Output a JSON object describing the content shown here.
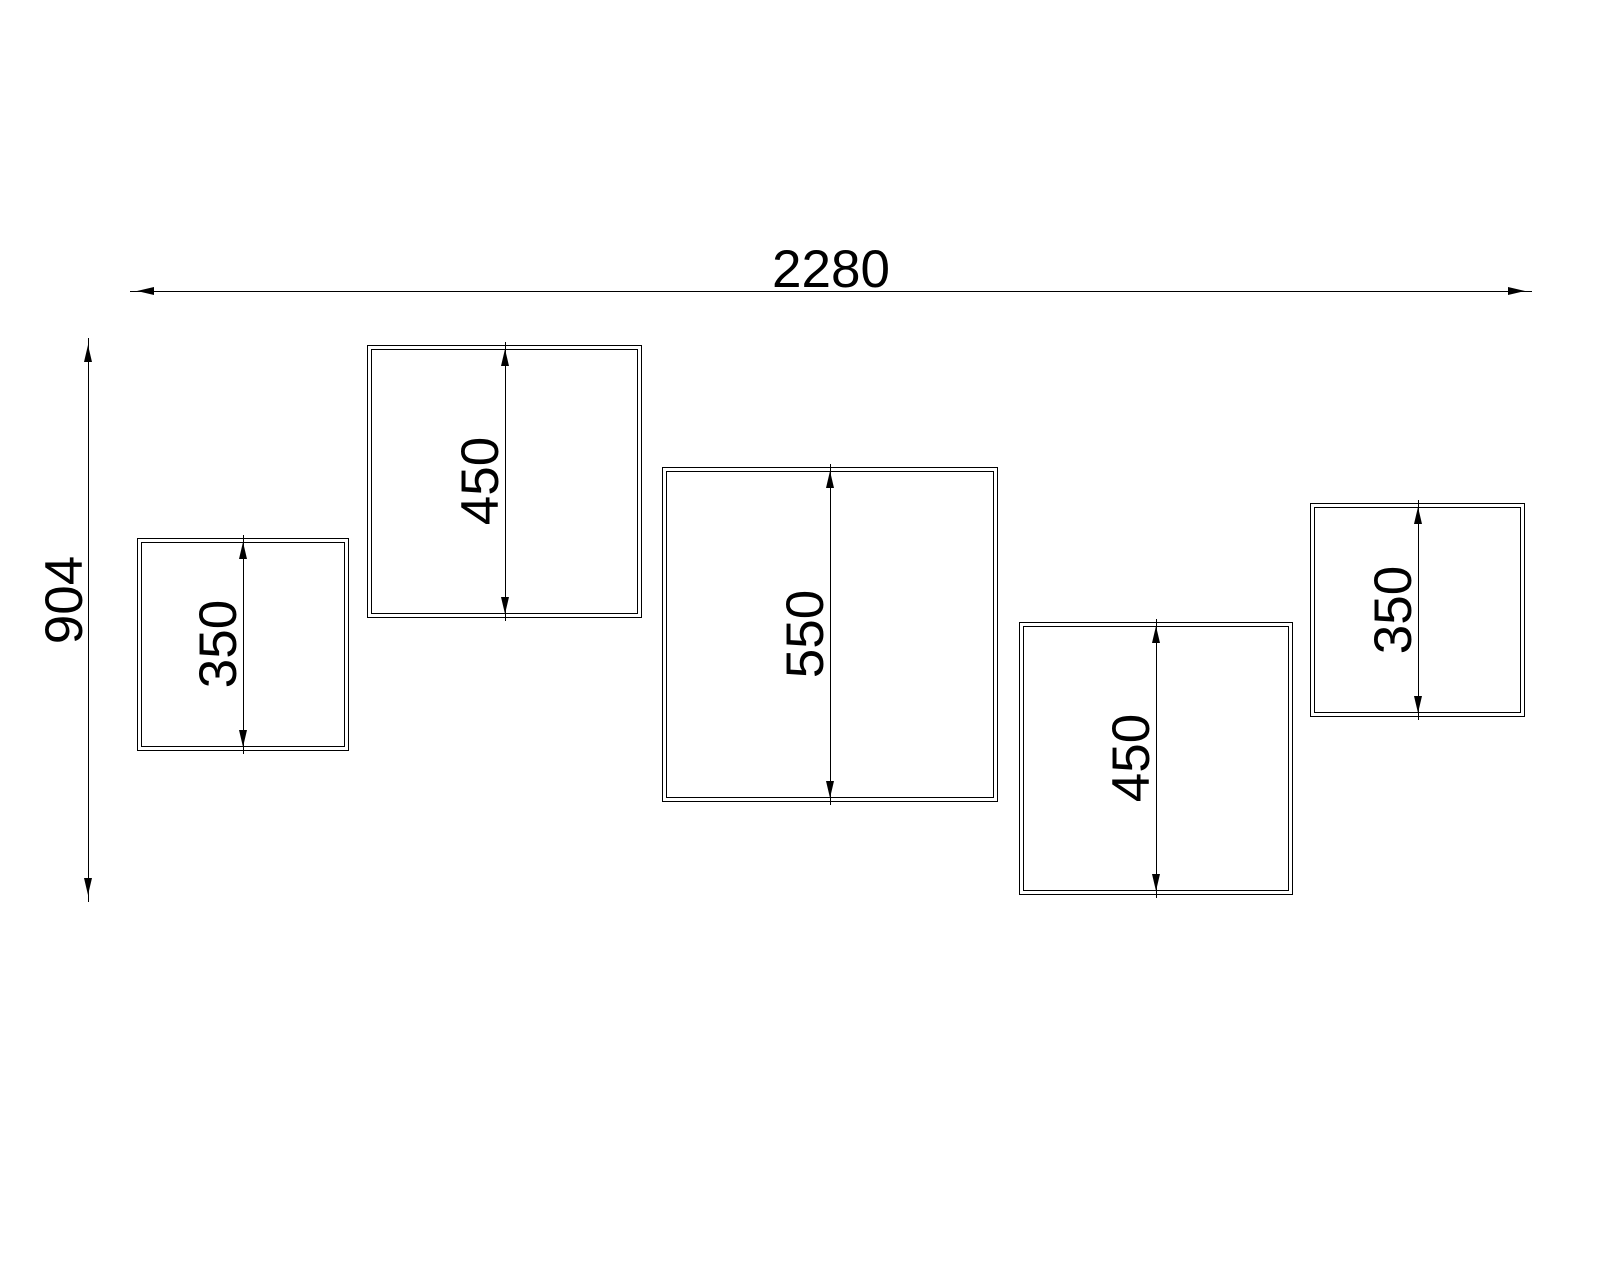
{
  "drawing": {
    "background_color": "#ffffff",
    "line_color": "#000000",
    "overall_width_label": "2280",
    "overall_height_label": "904",
    "panels": [
      {
        "height_label": "350",
        "height_value": 350
      },
      {
        "height_label": "450",
        "height_value": 450
      },
      {
        "height_label": "550",
        "height_value": 550
      },
      {
        "height_label": "450",
        "height_value": 450
      },
      {
        "height_label": "350",
        "height_value": 350
      }
    ],
    "overall_width_value": 2280,
    "overall_height_value": 904
  }
}
